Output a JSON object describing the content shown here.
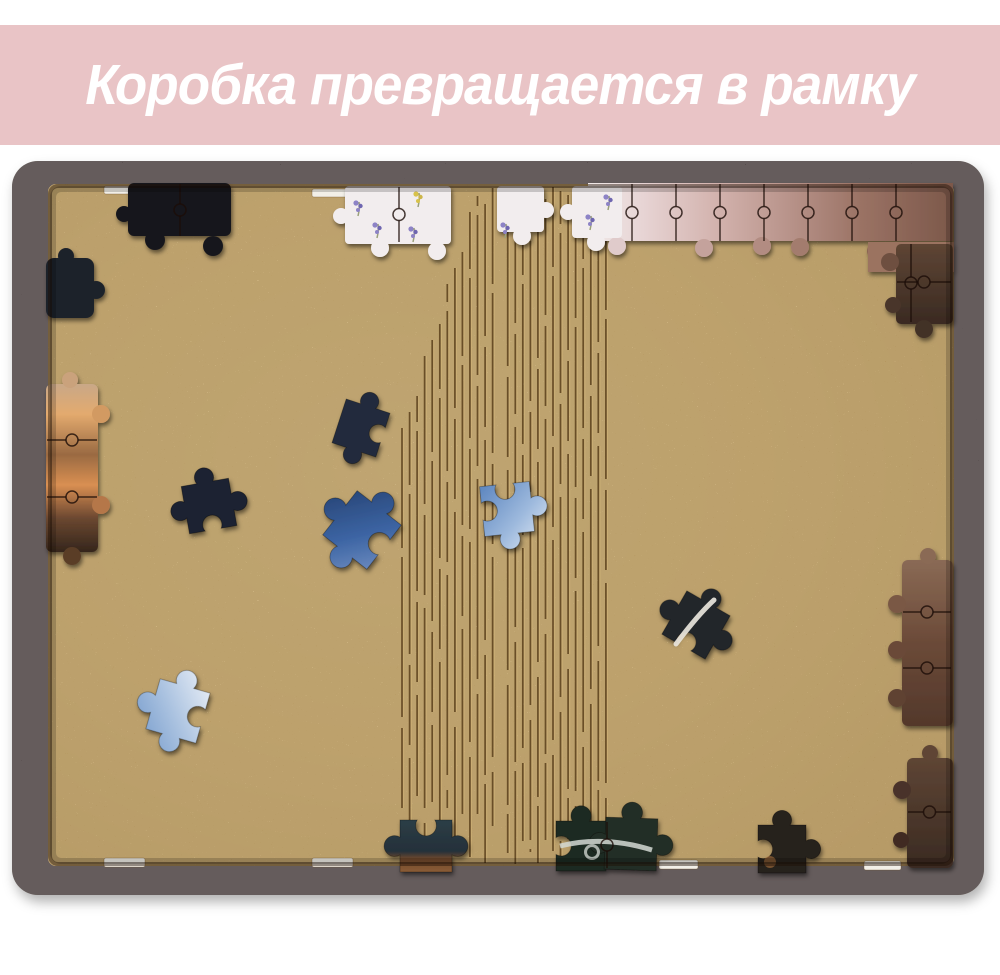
{
  "banner": {
    "text": "Коробка превращается в рамку",
    "background_color": "#e9c4c6",
    "text_color": "#ffffff"
  },
  "photo": {
    "colors": {
      "page_bg": "#ffffff",
      "frame": "#231713",
      "board": "#cfa968",
      "hinge_line": "#5e431e",
      "slot": "#f2efe8",
      "piece_black": "#17181c",
      "piece_navy": "#232c3e",
      "piece_blue": "#2f4f82",
      "piece_sky": "#7fa3d2",
      "piece_white": "#f2edee",
      "piece_mauve": "#b08a84",
      "piece_brown": "#6a4b3a",
      "piece_orange": "#d08a4e"
    }
  }
}
